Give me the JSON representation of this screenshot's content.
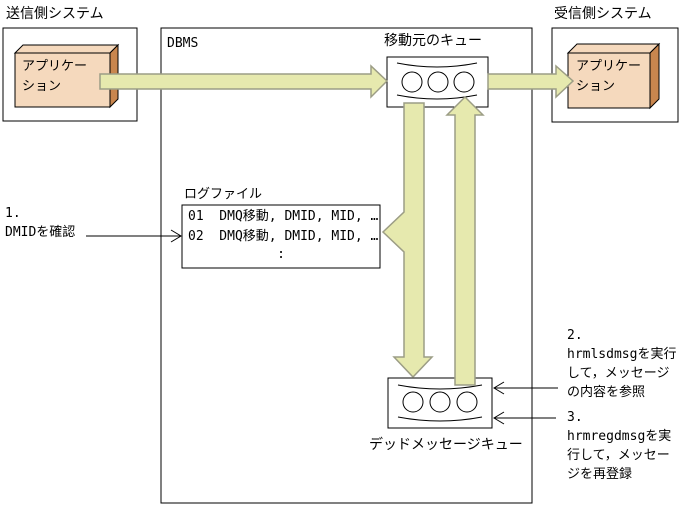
{
  "colors": {
    "arrow_fill": "#e6e9ae",
    "arrow_stroke": "#9c9d85",
    "app_face": "#f5d9bd",
    "app_side": "#c9864e",
    "line": "#000000",
    "background": "#ffffff"
  },
  "systems": {
    "sender": {
      "title": "送信側システム",
      "app_label": "アプリケー\nション"
    },
    "receiver": {
      "title": "受信側システム",
      "app_label": "アプリケー\nション"
    }
  },
  "dbms": {
    "label": "DBMS",
    "source_queue_label": "移動元のキュー",
    "dead_queue_label": "デッドメッセージキュー",
    "logfile": {
      "title": "ログファイル",
      "rows": [
        "01  DMQ移動, DMID, MID, …",
        "02  DMQ移動, DMID, MID, …",
        ":"
      ]
    }
  },
  "notes": {
    "step1": "1.\nDMIDを確認",
    "step2": "2.\nhrmlsdmsgを実行\nして，メッセージ\nの内容を参照",
    "step3": "3.\nhrmregdmsgを実\n行して，メッセー\nジを再登録"
  }
}
